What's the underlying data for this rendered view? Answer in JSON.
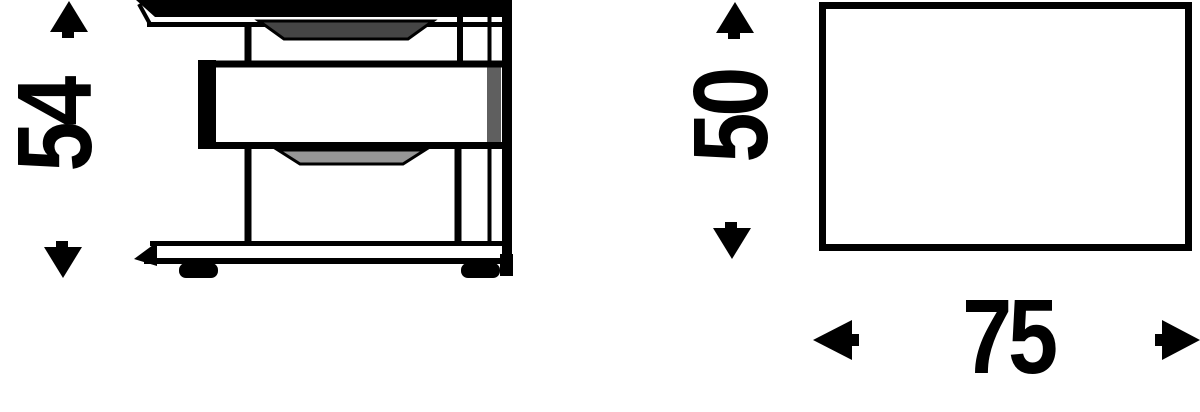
{
  "canvas": {
    "width": 1200,
    "height": 412,
    "background": "#ffffff",
    "line_color": "#000000"
  },
  "views": {
    "front": {
      "title": "nightstand-front-view",
      "description": "Line drawing of a two-drawer nightstand with top panel, protruding middle drawer, recessed drawer fronts, plinth base and two feet",
      "height_dimension": {
        "value": "54",
        "orientation": "vertical",
        "arrow_icons": [
          "arrow-up-icon",
          "arrow-down-icon"
        ]
      }
    },
    "plan": {
      "title": "nightstand-plan-view",
      "description": "Plain rectangle outline representing the top-down footprint",
      "depth_dimension": {
        "value": "50",
        "orientation": "vertical",
        "arrow_icons": [
          "arrow-up-icon",
          "arrow-down-icon"
        ]
      },
      "width_dimension": {
        "value": "75",
        "orientation": "horizontal",
        "arrow_icons": [
          "arrow-left-icon",
          "arrow-right-icon"
        ]
      }
    }
  },
  "colors": {
    "ink": "#000000",
    "recess_dark": "#454545",
    "recess_light": "#969696",
    "panel_shadow": "#5f5f5f"
  }
}
